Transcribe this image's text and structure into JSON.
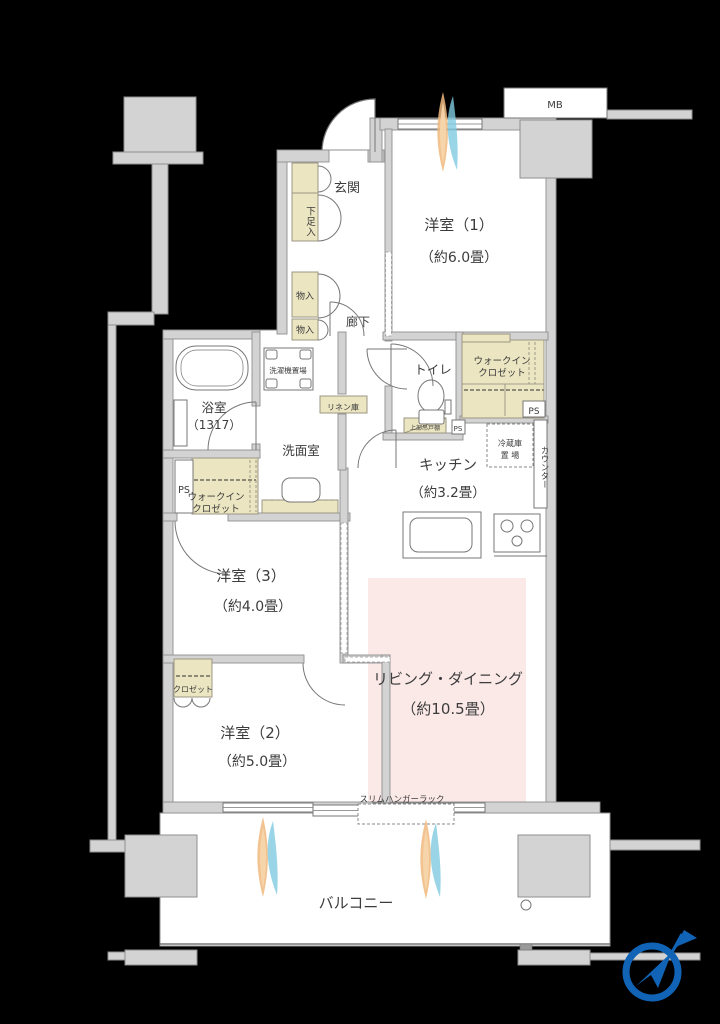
{
  "title": "マンション間取り図",
  "labels": {
    "mb": "MB",
    "genkan": "玄関",
    "shoe": "下足入",
    "storage1": "物入",
    "storage2": "物入",
    "hallway": "廊下",
    "room1_name": "洋室（1）",
    "room1_size": "（約6.0畳）",
    "toilet": "トイレ",
    "wic1_line1": "ウォークイン",
    "wic1_line2": "クロゼット",
    "ps_right": "PS",
    "ps_toilet": "PS",
    "ps_left": "PS",
    "cabinet": "上部吊戸棚",
    "fridge_line1": "冷蔵庫",
    "fridge_line2": "置 場",
    "counter": "カウンター",
    "kitchen_name": "キッチン",
    "kitchen_size": "（約3.2畳）",
    "bath_name": "浴室",
    "bath_size": "（1317）",
    "washer": "洗濯機置場",
    "linen": "リネン庫",
    "powder": "洗面室",
    "wic2_line1": "ウォークイン",
    "wic2_line2": "クロゼット",
    "room3_name": "洋室（3）",
    "room3_size": "（約4.0畳）",
    "closet2": "クロゼット",
    "room2_name": "洋室（2）",
    "room2_size": "（約5.0畳）",
    "ld_name": "リビング・ダイニング",
    "ld_size": "（約10.5畳）",
    "hanger": "スリムハンガーラック",
    "balcony": "バルコニー"
  },
  "colors": {
    "wall_gray": "#D3D3D3",
    "storage_beige": "#EBE5C1",
    "living_pink": "#FBE9E8",
    "compass_blue": "#1163B5",
    "airflow_orange": "#F0B87D",
    "airflow_blue": "#7FCBE0",
    "line_gray": "#777777",
    "text_gray": "#3C3C3C"
  }
}
